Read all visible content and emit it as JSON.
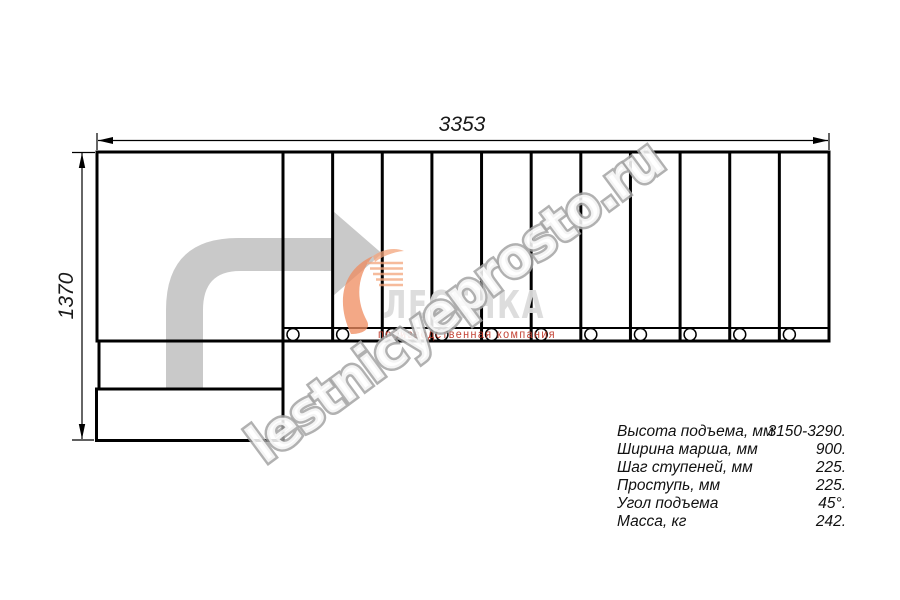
{
  "drawing": {
    "type": "staircase-plan",
    "dimensions": {
      "overall_length_mm": "3353",
      "overall_width_mm": "1370"
    },
    "diagram": {
      "straight_steps": 11,
      "entry_steps": 2,
      "posts": 11,
      "direction_arrow": "up-then-turn-right"
    }
  },
  "specs": {
    "rows": [
      {
        "label": "Высота подъема, мм",
        "value": "3150-3290."
      },
      {
        "label": "Ширина марша, мм",
        "value": "900."
      },
      {
        "label": "Шаг ступеней, мм",
        "value": "225."
      },
      {
        "label": "Проступь, мм",
        "value": "225."
      },
      {
        "label": "Угол подъема",
        "value": "45°."
      },
      {
        "label": "Масса, кг",
        "value": "242."
      }
    ]
  },
  "logo": {
    "name": "ЛЕСЕНКА",
    "tagline": "производственная компания"
  },
  "watermark": {
    "text": "lestnicyeprosto.ru"
  },
  "colors": {
    "line": "#000000",
    "direction_arrow": "#c9c9c9",
    "watermark_outline": "#a3a3a3",
    "logo_name_gray": "#dcdcdc",
    "logo_swoosh_orange": "#ef8c60",
    "logo_tagline_red": "#c0392b"
  }
}
